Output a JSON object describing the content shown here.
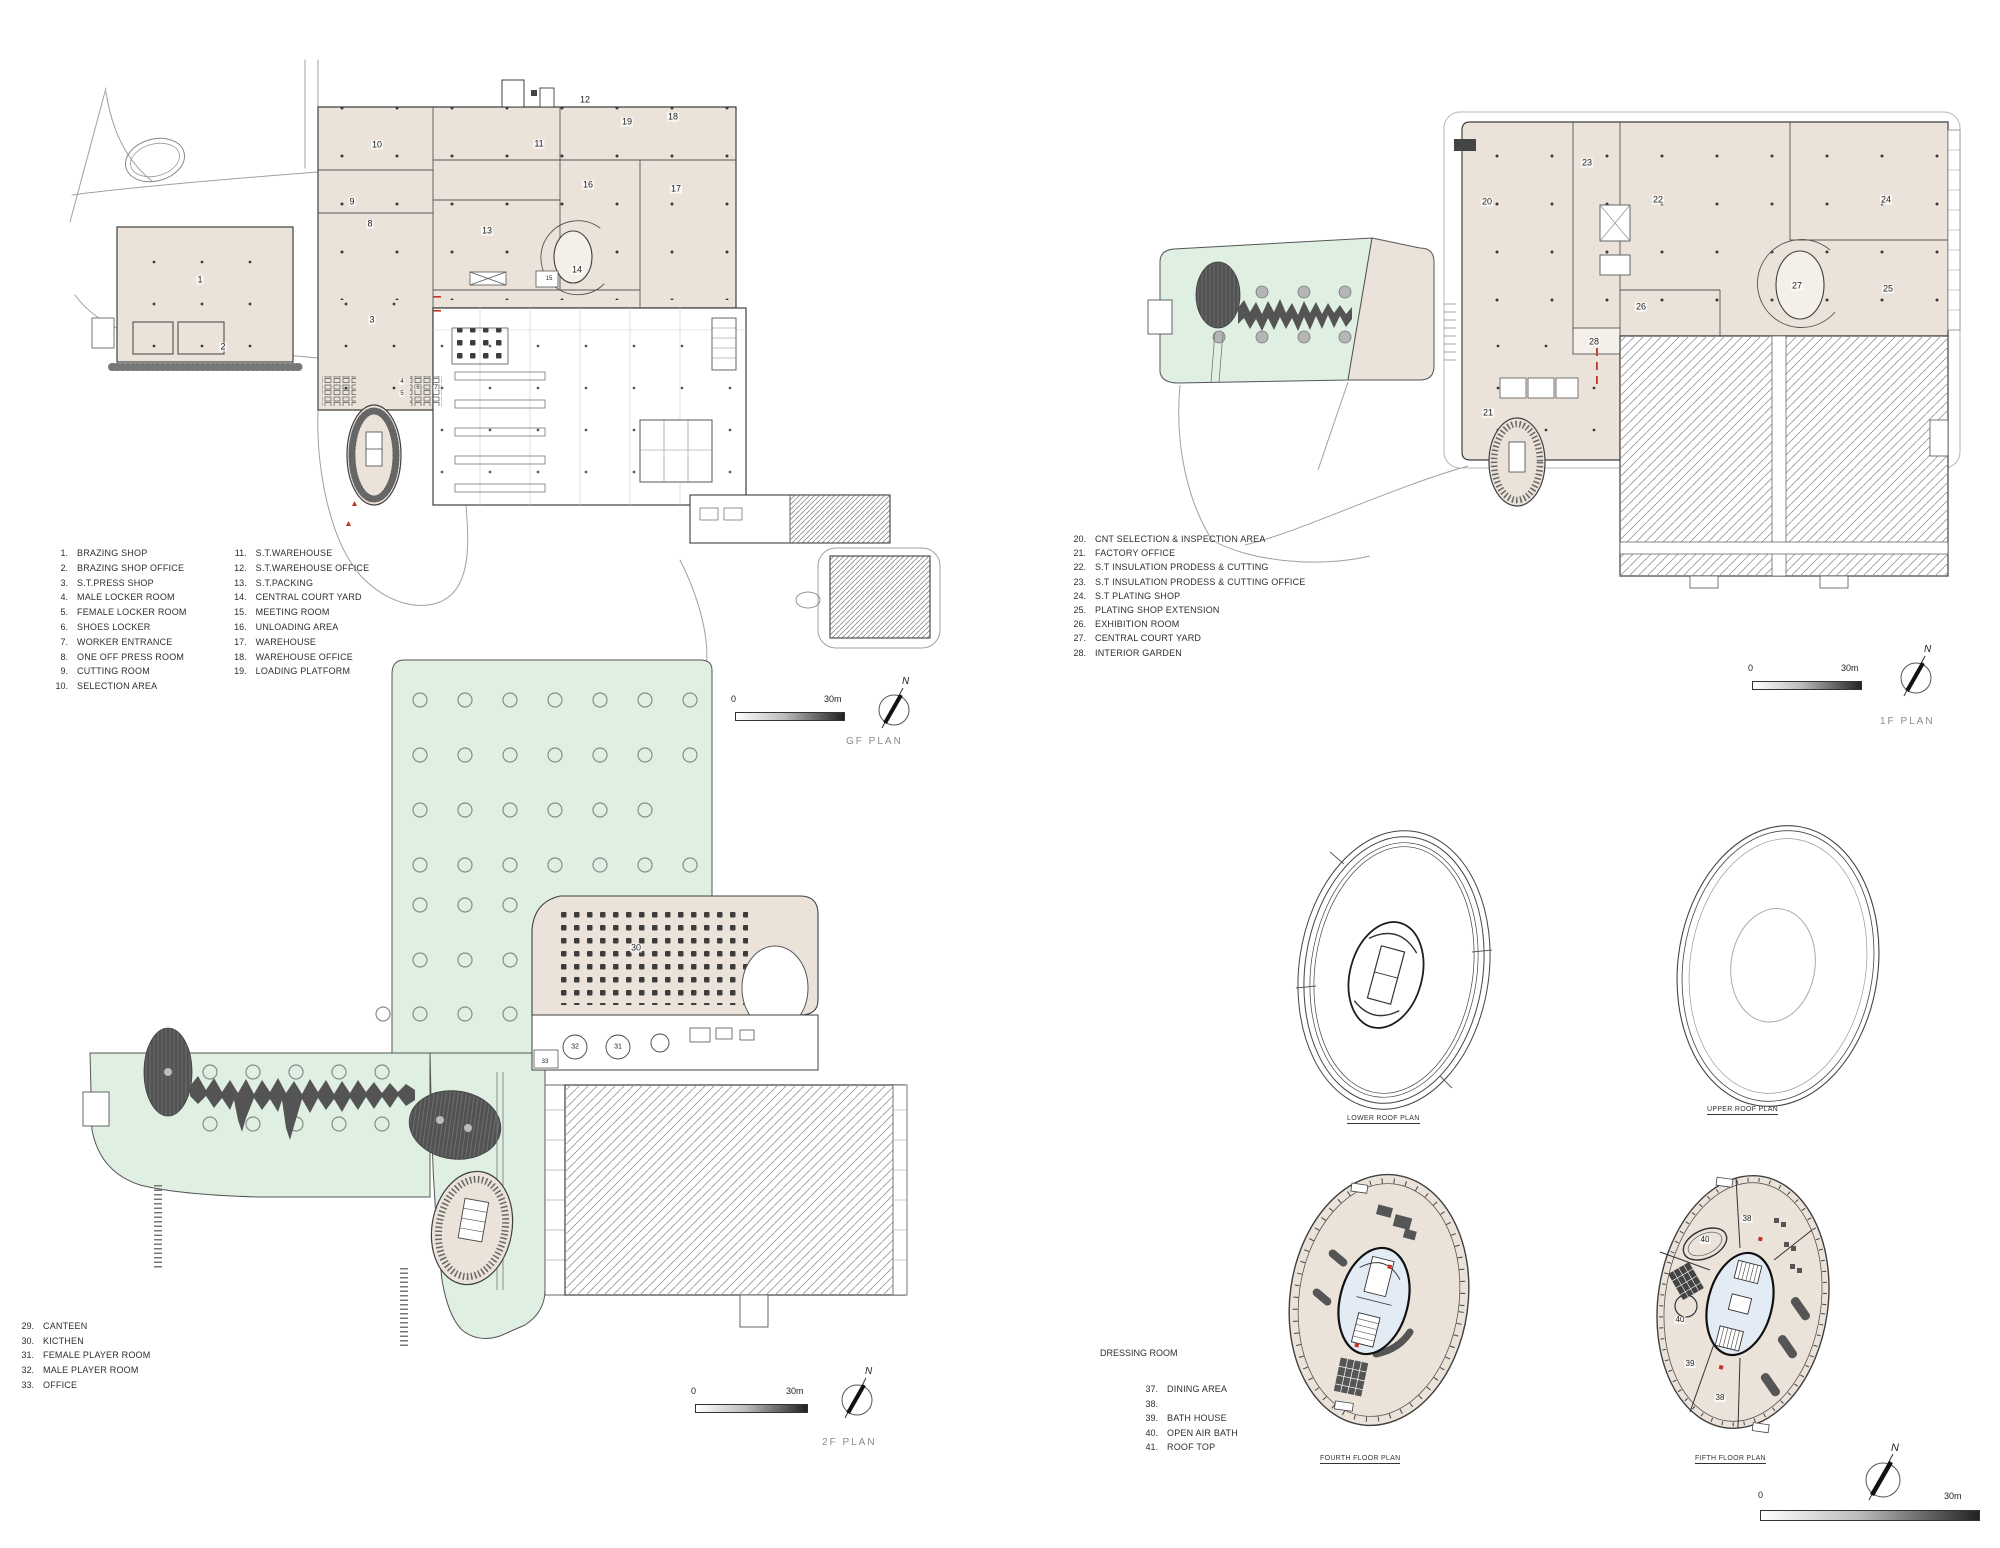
{
  "colors": {
    "building_fill": "#ebe3da",
    "green_fill": "#dff0e3",
    "core_fill": "#e3ebf4",
    "tree_fill": "#545454",
    "wall": "#3f3f3f",
    "accent_red": "#c23327"
  },
  "plans": {
    "gf": {
      "title": "GF PLAN",
      "scale_start": "0",
      "scale_end": "30m",
      "north": "N",
      "legend_col1": [
        {
          "num": "1.",
          "label": "BRAZING SHOP"
        },
        {
          "num": "2.",
          "label": "BRAZING SHOP OFFICE"
        },
        {
          "num": "3.",
          "label": "S.T.PRESS SHOP"
        },
        {
          "num": "4.",
          "label": "MALE LOCKER ROOM"
        },
        {
          "num": "5.",
          "label": "FEMALE LOCKER ROOM"
        },
        {
          "num": "6.",
          "label": "SHOES LOCKER"
        },
        {
          "num": "7.",
          "label": "WORKER ENTRANCE"
        },
        {
          "num": "8.",
          "label": "ONE OFF PRESS ROOM"
        },
        {
          "num": "9.",
          "label": "CUTTING ROOM"
        },
        {
          "num": "10.",
          "label": "SELECTION AREA"
        }
      ],
      "legend_col2": [
        {
          "num": "11.",
          "label": "S.T.WAREHOUSE"
        },
        {
          "num": "12.",
          "label": "S.T.WAREHOUSE OFFICE"
        },
        {
          "num": "13.",
          "label": "S.T.PACKING"
        },
        {
          "num": "14.",
          "label": "CENTRAL COURT YARD"
        },
        {
          "num": "15.",
          "label": "MEETING ROOM"
        },
        {
          "num": "16.",
          "label": "UNLOADING AREA"
        },
        {
          "num": "17.",
          "label": "WAREHOUSE"
        },
        {
          "num": "18.",
          "label": "WAREHOUSE OFFICE"
        },
        {
          "num": "19.",
          "label": "LOADING PLATFORM"
        }
      ]
    },
    "f1": {
      "title": "1F PLAN",
      "scale_start": "0",
      "scale_end": "30m",
      "north": "N",
      "legend": [
        {
          "num": "20.",
          "label": "CNT SELECTION & INSPECTION AREA"
        },
        {
          "num": "21.",
          "label": "FACTORY OFFICE"
        },
        {
          "num": "22.",
          "label": "S.T INSULATION PRODESS & CUTTING"
        },
        {
          "num": "23.",
          "label": "S.T INSULATION PRODESS & CUTTING OFFICE"
        },
        {
          "num": "24.",
          "label": "S.T PLATING SHOP"
        },
        {
          "num": "25.",
          "label": "PLATING SHOP EXTENSION"
        },
        {
          "num": "26.",
          "label": "EXHIBITION ROOM"
        },
        {
          "num": "27.",
          "label": "CENTRAL COURT YARD"
        },
        {
          "num": "28.",
          "label": "INTERIOR GARDEN"
        }
      ]
    },
    "f2": {
      "title": "2F PLAN",
      "scale_start": "0",
      "scale_end": "30m",
      "north": "N",
      "legend": [
        {
          "num": "29.",
          "label": "CANTEEN"
        },
        {
          "num": "30.",
          "label": "KICTHEN"
        },
        {
          "num": "31.",
          "label": "FEMALE PLAYER ROOM"
        },
        {
          "num": "32.",
          "label": "MALE PLAYER ROOM"
        },
        {
          "num": "33.",
          "label": "OFFICE"
        }
      ]
    },
    "roof": {
      "dressing_room": "DRESSING ROOM",
      "scale_start": "0",
      "scale_end": "30m",
      "north": "N",
      "labels": {
        "lower": "LOWER ROOF PLAN",
        "upper": "UPPER ROOF PLAN",
        "fourth": "FOURTH FLOOR PLAN",
        "fifth": "FIFTH FLOOR PLAN"
      },
      "legend": [
        {
          "num": "37.",
          "label": "DINING AREA"
        },
        {
          "num": "38.",
          "label": ""
        },
        {
          "num": "39.",
          "label": "BATH HOUSE"
        },
        {
          "num": "40.",
          "label": "OPEN AIR BATH"
        },
        {
          "num": "41.",
          "label": "ROOF TOP"
        }
      ]
    }
  },
  "room_labels": [
    {
      "t": "1",
      "x": 200,
      "y": 280
    },
    {
      "t": "2",
      "x": 223,
      "y": 347
    },
    {
      "t": "3",
      "x": 372,
      "y": 320
    },
    {
      "t": "4",
      "x": 402,
      "y": 382,
      "s": 6
    },
    {
      "t": "5",
      "x": 402,
      "y": 394,
      "s": 6
    },
    {
      "t": "6",
      "x": 418,
      "y": 388,
      "s": 6
    },
    {
      "t": "7",
      "x": 436,
      "y": 388,
      "s": 6
    },
    {
      "t": "8",
      "x": 370,
      "y": 224
    },
    {
      "t": "9",
      "x": 352,
      "y": 202
    },
    {
      "t": "10",
      "x": 377,
      "y": 145
    },
    {
      "t": "11",
      "x": 539,
      "y": 144
    },
    {
      "t": "12",
      "x": 585,
      "y": 100
    },
    {
      "t": "13",
      "x": 487,
      "y": 231
    },
    {
      "t": "14",
      "x": 577,
      "y": 270
    },
    {
      "t": "15",
      "x": 549,
      "y": 279,
      "s": 6
    },
    {
      "t": "16",
      "x": 588,
      "y": 185
    },
    {
      "t": "17",
      "x": 676,
      "y": 189
    },
    {
      "t": "18",
      "x": 673,
      "y": 117
    },
    {
      "t": "19",
      "x": 627,
      "y": 122
    },
    {
      "t": "20",
      "x": 1487,
      "y": 202
    },
    {
      "t": "21",
      "x": 1488,
      "y": 413
    },
    {
      "t": "22",
      "x": 1658,
      "y": 200
    },
    {
      "t": "23",
      "x": 1587,
      "y": 163
    },
    {
      "t": "24",
      "x": 1886,
      "y": 200
    },
    {
      "t": "25",
      "x": 1888,
      "y": 289
    },
    {
      "t": "26",
      "x": 1641,
      "y": 307
    },
    {
      "t": "27",
      "x": 1797,
      "y": 286
    },
    {
      "t": "28",
      "x": 1594,
      "y": 342
    },
    {
      "t": "30",
      "x": 636,
      "y": 948
    },
    {
      "t": "31",
      "x": 618,
      "y": 1047,
      "s": 7
    },
    {
      "t": "32",
      "x": 575,
      "y": 1047,
      "s": 7
    },
    {
      "t": "33",
      "x": 545,
      "y": 1062,
      "s": 6
    },
    {
      "t": "38",
      "x": 1747,
      "y": 1219,
      "s": 8
    },
    {
      "t": "40",
      "x": 1705,
      "y": 1240,
      "s": 8
    },
    {
      "t": "40",
      "x": 1680,
      "y": 1320,
      "s": 8
    },
    {
      "t": "39",
      "x": 1690,
      "y": 1364,
      "s": 8
    },
    {
      "t": "38",
      "x": 1720,
      "y": 1398,
      "s": 8
    }
  ]
}
